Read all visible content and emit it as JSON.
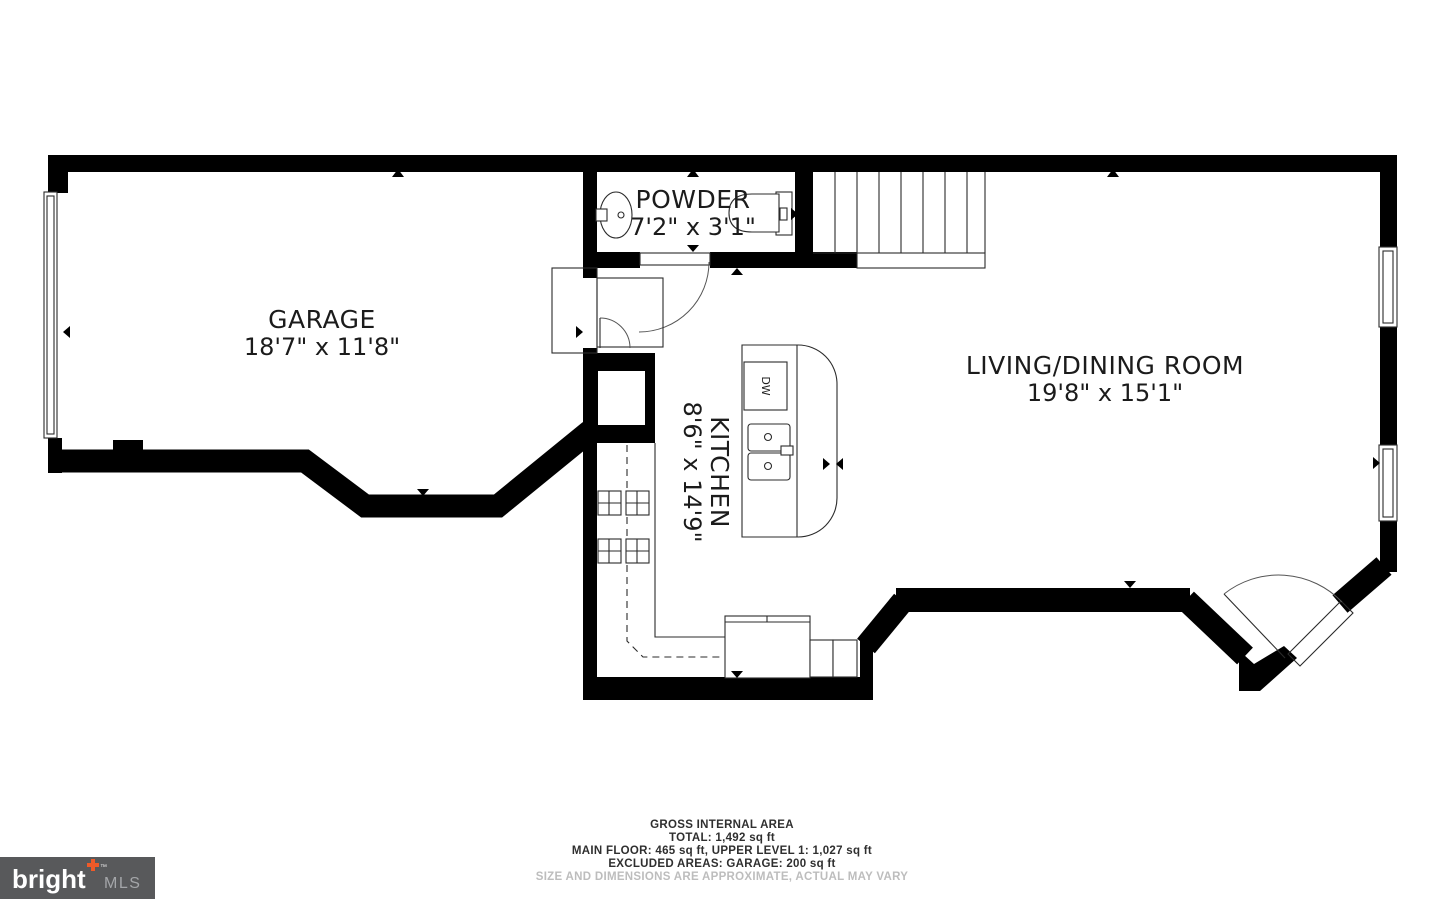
{
  "plan": {
    "rooms": {
      "garage": {
        "name": "GARAGE",
        "dims": "18'7\" x 11'8\""
      },
      "powder": {
        "name": "POWDER",
        "dims": "7'2\" x 3'1\""
      },
      "kitchen": {
        "name": "KITCHEN",
        "dims": "8'6\" x 14'9\""
      },
      "living_dining": {
        "name": "LIVING/DINING ROOM",
        "dims": "19'8\" x 15'1\""
      }
    },
    "labels": {
      "dishwasher": "DW"
    }
  },
  "footer": {
    "line1": "GROSS INTERNAL AREA",
    "line2": "TOTAL: 1,492 sq ft",
    "line3": "MAIN FLOOR: 465 sq ft, UPPER LEVEL 1: 1,027 sq ft",
    "line4": "EXCLUDED AREAS: GARAGE: 200 sq ft",
    "line5": "SIZE AND DIMENSIONS ARE APPROXIMATE, ACTUAL MAY VARY"
  },
  "logo": {
    "brand": "bright",
    "tm": "™",
    "suffix": "MLS"
  },
  "colors": {
    "wall": "#000000",
    "label_text": "#1b1b1b",
    "footer_text": "#2f2f2f",
    "footer_muted": "#bdbdbd",
    "logo_bg": "#58595b",
    "logo_accent": "#f05a28",
    "logo_mls": "#a4a6a9"
  }
}
